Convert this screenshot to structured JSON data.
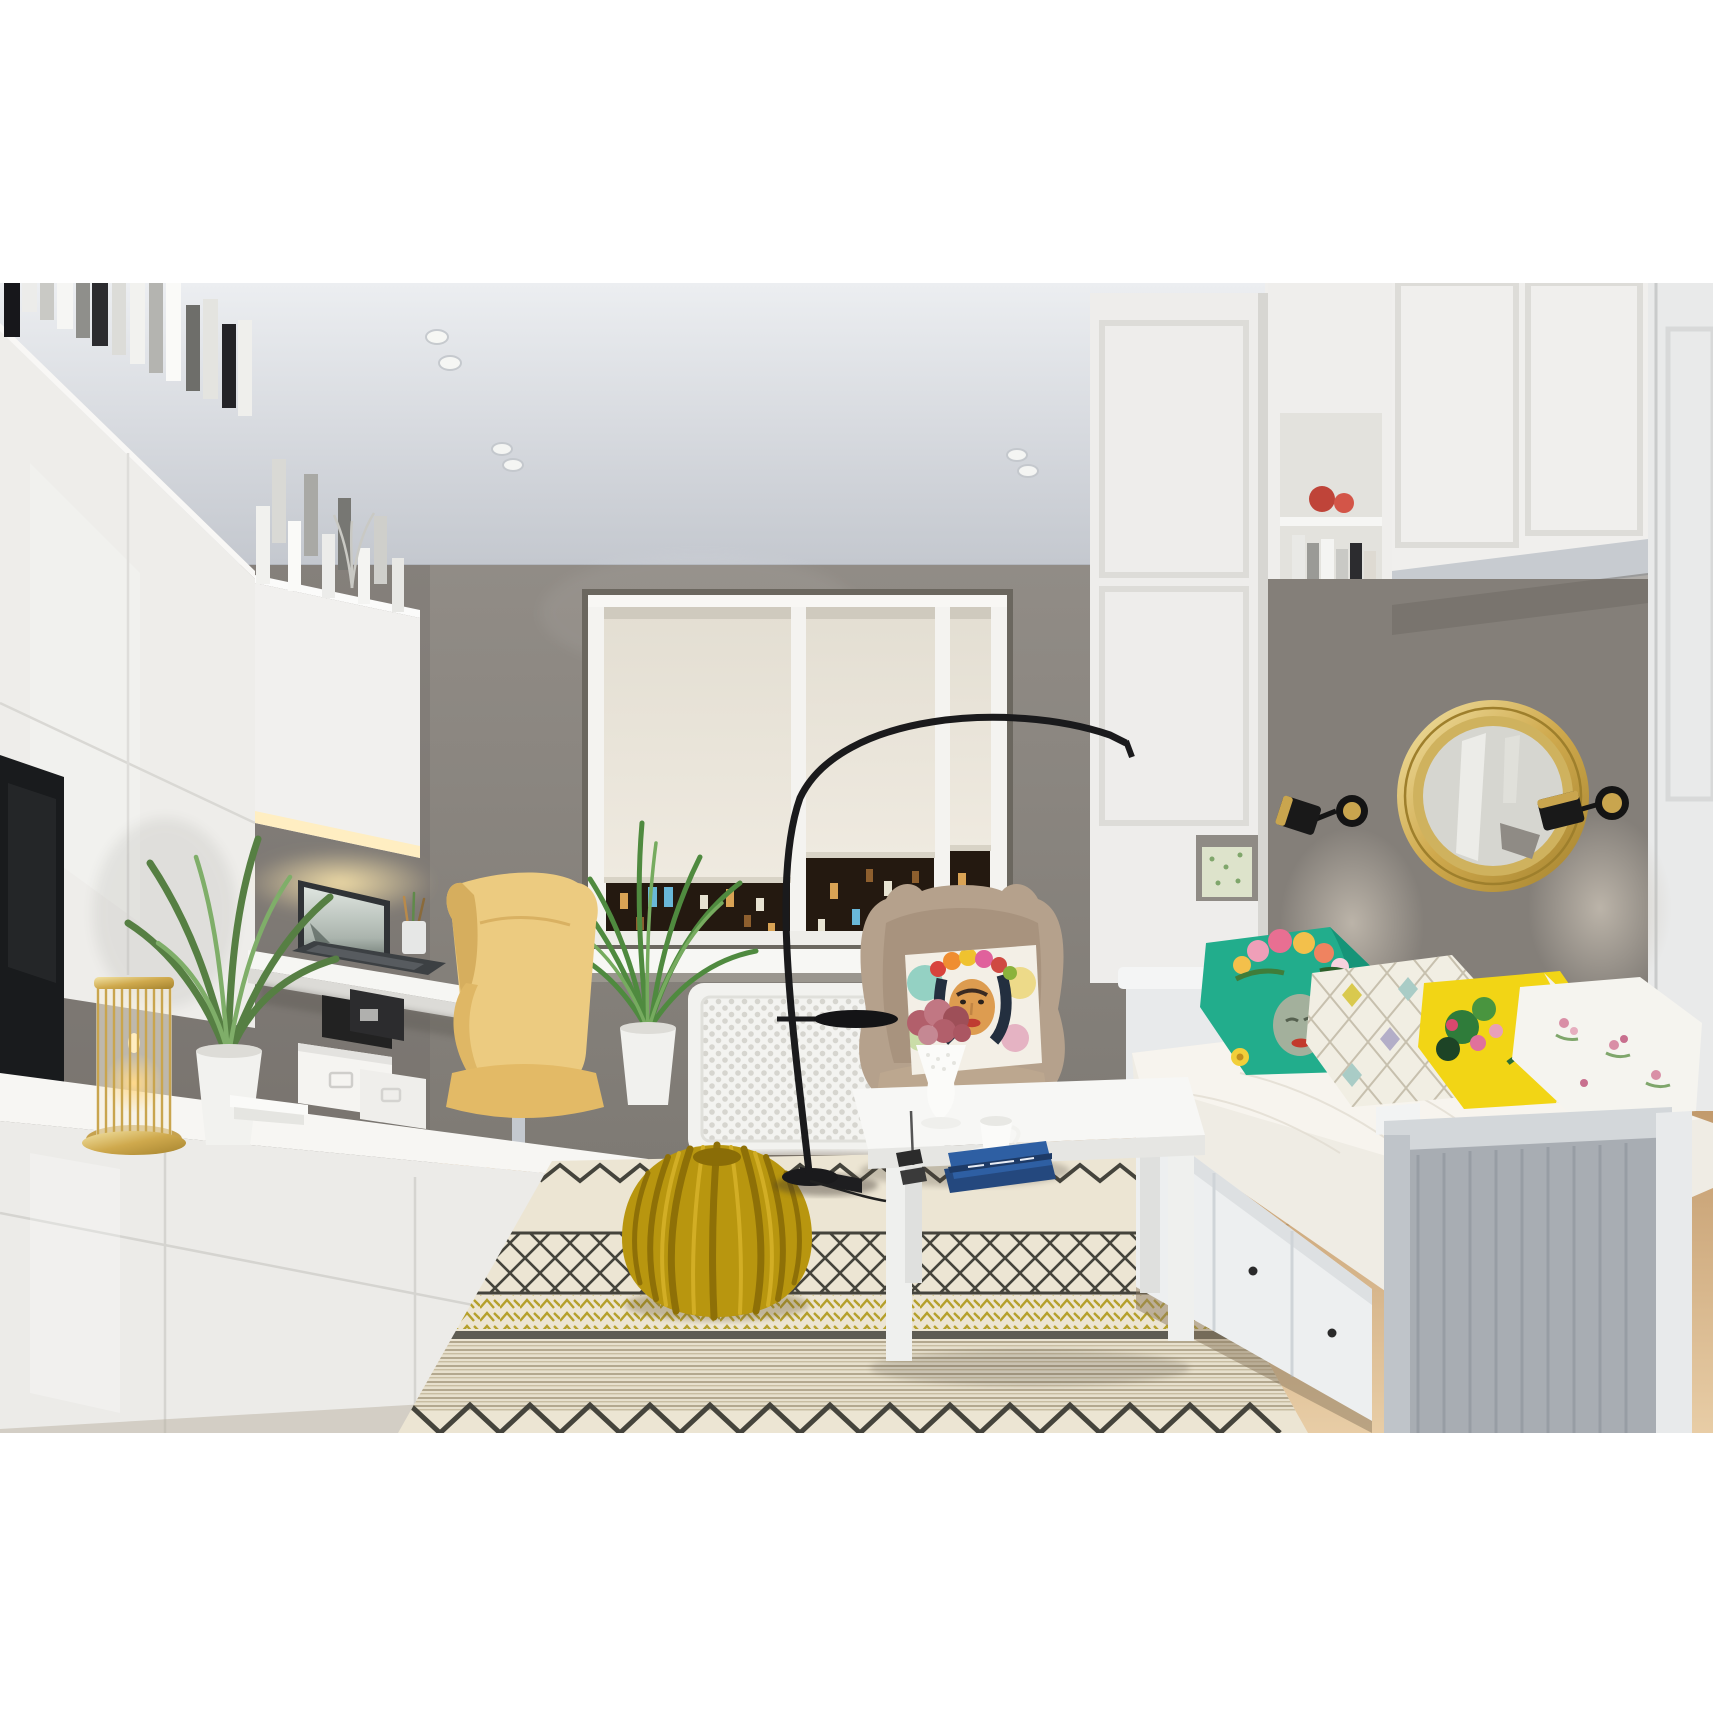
{
  "scene": {
    "type": "interior-render",
    "description": "3D rendering of a small modern living room at night: white gloss wall unit with books and TV on the left, floating desk with laptop and yellow office chair, triple window with cream roller blinds and night city view, beige wingback armchair with a Frida Kahlo watercolor pillow, black arc floor lamp, mustard knitted pouf on a patterned scandinavian rug, white coffee table with a blue book and coffee cup, white daybed with colorful pillows under a round gold mirror flanked by two black-gold sconces, white shaker cabinets and wardrobe on the right, light wood floor.",
    "palette": {
      "page_background": "#ffffff",
      "ceiling": "#d7dade",
      "wall_gray": "#8b8680",
      "accent_wall": "#847f79",
      "white_furniture": "#efeeec",
      "wood_floor": "#d9b78c",
      "rug_cream": "#ece5d3",
      "rug_pattern_dark": "#45443c",
      "rug_yellow": "#b5a02b",
      "pouf_mustard": "#b8960f",
      "armchair_beige": "#b5a18c",
      "office_chair_yellow": "#eccb80",
      "gold": "#c9a54e",
      "teal_pillow": "#22ad8c",
      "yellow_pillow": "#f2d515",
      "chevron_pillow": "#f1eee3",
      "night_view": "#23180f",
      "blind_cream": "#eae5da",
      "tv_black": "#191b1d",
      "mattress": "#efece4",
      "footboard_shadow": "#a8adb3",
      "book_blue": "#2e5fa3",
      "flowers_mauve": "#b25f6b",
      "sconce_black": "#141414"
    },
    "objects": {
      "ceiling": {
        "label": "ceiling with recessed spotlights"
      },
      "back_wall": {
        "label": "gray painted wall"
      },
      "window": {
        "label": "triple window, white frame"
      },
      "roller_blinds": {
        "label": "three cream roller blinds, lowered"
      },
      "night_city": {
        "label": "night city view with lit building windows"
      },
      "windowsill_plant": {
        "label": "spiky green plant in white pot on windowsill"
      },
      "radiator": {
        "label": "white perforated radiator cover"
      },
      "wall_unit": {
        "label": "white gloss wall unit with books on top"
      },
      "tv": {
        "label": "flat TV on left wall"
      },
      "floating_cabinet": {
        "label": "floating cabinet with under-cabinet light"
      },
      "desk": {
        "label": "white floating desk"
      },
      "laptop": {
        "label": "open laptop on desk"
      },
      "pencil_cup": {
        "label": "pencil cup with pencils"
      },
      "desk_chair": {
        "label": "yellow high-back office chair on castors"
      },
      "sideboard": {
        "label": "white gloss sideboard"
      },
      "candle_lantern": {
        "label": "gold candle lantern"
      },
      "sideboard_plant": {
        "label": "green plant in white vase"
      },
      "storage_boxes": {
        "label": "white and black storage boxes"
      },
      "arc_lamp": {
        "label": "black arc floor lamp with round tray"
      },
      "armchair": {
        "label": "beige wingback armchair"
      },
      "frida_pillow": {
        "label": "watercolor Frida Kahlo portrait pillow"
      },
      "pouf": {
        "label": "mustard knitted pouf"
      },
      "rug": {
        "label": "cream rug with graphic stripes, diamonds and yellow chevrons"
      },
      "coffee_table": {
        "label": "white coffee table"
      },
      "flower_vase": {
        "label": "white goblet vase with mauve flowers"
      },
      "coffee_cup": {
        "label": "white coffee cup on saucer"
      },
      "table_books": {
        "label": "blue books on coffee table"
      },
      "daybed": {
        "label": "white daybed with storage drawers"
      },
      "drawers": {
        "label": "three drawers with black knobs"
      },
      "footboard": {
        "label": "paneled footboard in shadow"
      },
      "pillow_teal": {
        "label": "teal pillow with flower-crowned face print"
      },
      "pillow_chevron": {
        "label": "pastel diamond pattern pillow"
      },
      "pillow_yellow": {
        "label": "yellow tropical floral pillow"
      },
      "pillow_white": {
        "label": "white floral pillow"
      },
      "overbed_cabinets": {
        "label": "white shaker bridge cabinets over bed"
      },
      "open_shelf": {
        "label": "open shelf with books and red bowl"
      },
      "niche_box": {
        "label": "floral storage box in open niche"
      },
      "accent_panel": {
        "label": "gray accent wall behind bed"
      },
      "mirror": {
        "label": "round gold-framed mirror"
      },
      "sconce_left": {
        "label": "black and gold wall sconce, left"
      },
      "sconce_right": {
        "label": "black and gold wall sconce, right"
      },
      "wardrobe": {
        "label": "tall white wardrobe on right"
      },
      "floor": {
        "label": "light wood plank floor"
      }
    }
  }
}
